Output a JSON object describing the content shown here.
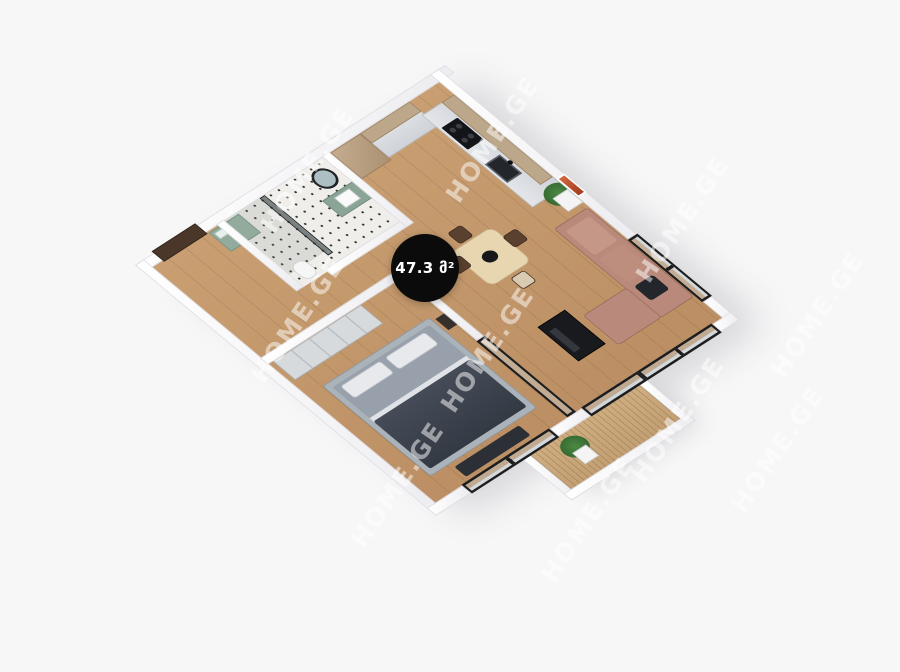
{
  "page": {
    "background": "#f7f7f8"
  },
  "overlay": {
    "area_badge": {
      "text": "47.3 მ²",
      "bg": "#0b0b0b",
      "text_color": "#ffffff"
    },
    "watermark": {
      "text": "HOME.GE",
      "color": "rgba(255,255,255,0.5)"
    }
  },
  "floor_plan": {
    "type": "isometric-3d-apartment-render",
    "total_area_sqm": "47.3",
    "rooms": [
      {
        "name": "entry-hall",
        "floor": "wood",
        "features": [
          "entrance-door-brown",
          "green-sideboard"
        ]
      },
      {
        "name": "bathroom",
        "floor": "white-terrazzo-tile",
        "features": [
          "glass-shower",
          "round-mirror",
          "green-vanity-with-sink",
          "toilet",
          "towel-rail"
        ]
      },
      {
        "name": "kitchen",
        "floor": "wood",
        "features": [
          "l-shaped-counter",
          "wood-upper-cabinets",
          "gray-lower-cabinets",
          "black-cooktop",
          "sink"
        ]
      },
      {
        "name": "living-dining",
        "floor": "wood",
        "features": [
          "dining-table",
          "four-chairs",
          "rose-sectional-sofa",
          "black-tv-console",
          "potted-plant",
          "orange-wall-art",
          "black-framed-windows"
        ]
      },
      {
        "name": "bedroom",
        "floor": "wood",
        "features": [
          "double-bed-gray-bedding",
          "wardrobe",
          "bench",
          "nightstand",
          "sliding-glass-door"
        ]
      },
      {
        "name": "balcony",
        "floor": "wood-deck",
        "features": [
          "potted-plant",
          "parapet-walls",
          "black-framed-sliders"
        ]
      }
    ],
    "colors": {
      "wall": "#ffffff",
      "wood_floor": "#c0976b",
      "bathroom_tile": "#efeeea",
      "deck": "#c9a87d",
      "sofa": "#b98a7c",
      "bed_blanket": "#3a414b",
      "cabinet_green": "#92ab9c",
      "frame_black": "#1d1d1f",
      "entrance_door_brown": "#4a372a",
      "art_orange": "#cc5b33",
      "plant_green": "#3f7a3f"
    }
  }
}
